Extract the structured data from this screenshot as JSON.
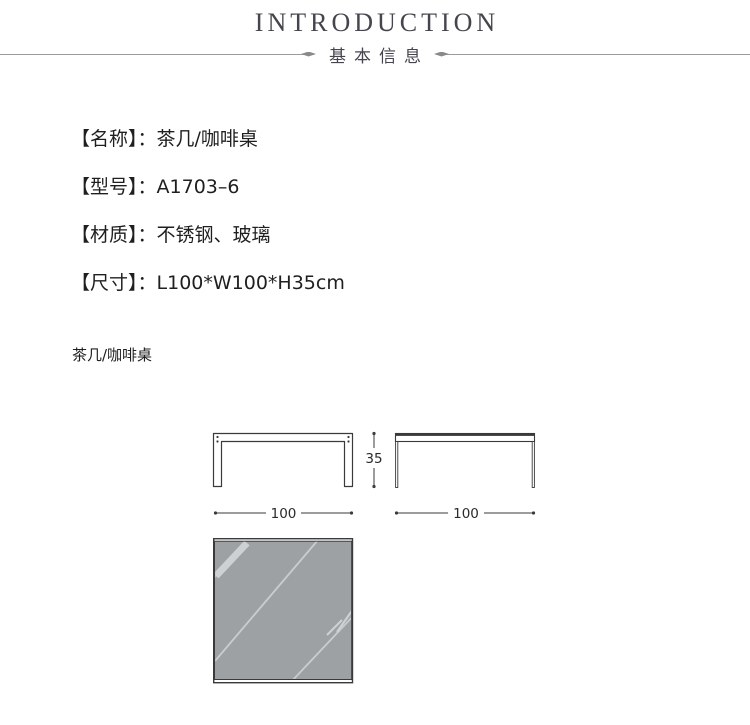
{
  "header": {
    "title": "INTRODUCTION",
    "subtitle": "基本信息"
  },
  "details": {
    "separator": "：",
    "rows": [
      {
        "label": "【名称】",
        "value": "茶几/咖啡桌"
      },
      {
        "label": "【型号】",
        "value": "A1703–6"
      },
      {
        "label": "【材质】",
        "value": "不锈钢、玻璃"
      },
      {
        "label": "【尺寸】",
        "value": "L100*W100*H35cm"
      }
    ]
  },
  "product_label": "茶几/咖啡桌",
  "drawings": {
    "front_width_label": "100",
    "side_width_label": "100",
    "height_label": "35"
  },
  "colors": {
    "title_text": "#45454d",
    "rule_line": "#9b9b9b",
    "body_text": "#1f1f1f",
    "drawing_line": "#3a3a3a",
    "glass_fill": "#9ea1a4",
    "glass_streak": "#cdd1d3"
  }
}
